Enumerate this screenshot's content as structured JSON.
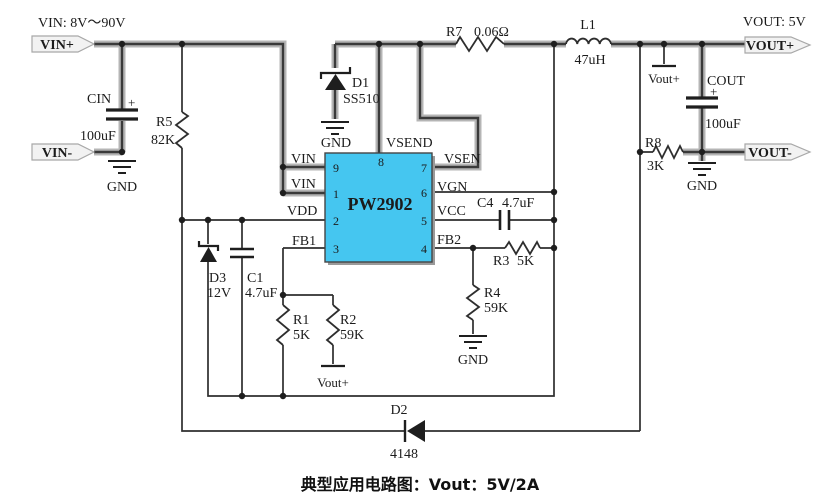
{
  "title": {
    "vin_spec": "VIN:  8V～90V",
    "vout_spec": "VOUT:  5V"
  },
  "caption": "典型应用电路图：Vout：5V/2A",
  "terminals": {
    "vin_plus": "VIN+",
    "vin_minus": "VIN-",
    "vout_plus": "VOUT+",
    "vout_minus": "VOUT-"
  },
  "net_labels": {
    "vout_ref_top": "Vout+",
    "vout_ref_bottom": "Vout+",
    "gnd": "GND"
  },
  "ic": {
    "part": "PW2902",
    "pins": {
      "p9": {
        "num": "9",
        "label": "VIN"
      },
      "p1": {
        "num": "1",
        "label": "VIN"
      },
      "p2": {
        "num": "2",
        "label": "VDD"
      },
      "p3": {
        "num": "3",
        "label": "FB1"
      },
      "p8": {
        "num": "8",
        "label": "VSEND"
      },
      "p7": {
        "num": "7",
        "label": "VSEN"
      },
      "p6": {
        "num": "6",
        "label": "VGN"
      },
      "p5": {
        "num": "5",
        "label": "VCC"
      },
      "p4": {
        "num": "4",
        "label": "FB2"
      }
    }
  },
  "components": {
    "cin": {
      "ref": "CIN",
      "value": "100uF",
      "polarity": "+"
    },
    "cout": {
      "ref": "COUT",
      "value": "100uF",
      "polarity": "+"
    },
    "c1": {
      "ref": "C1",
      "value": "4.7uF"
    },
    "c4": {
      "ref": "C4",
      "value": "4.7uF"
    },
    "r1": {
      "ref": "R1",
      "value": "5K"
    },
    "r2": {
      "ref": "R2",
      "value": "59K"
    },
    "r3": {
      "ref": "R3",
      "value": "5K"
    },
    "r4": {
      "ref": "R4",
      "value": "59K"
    },
    "r5": {
      "ref": "R5",
      "value": "82K"
    },
    "r7": {
      "ref": "R7",
      "value": "0.06Ω"
    },
    "r8": {
      "ref": "R8",
      "value": "3K"
    },
    "l1": {
      "ref": "L1",
      "value": "47uH"
    },
    "d1": {
      "ref": "D1",
      "value": "SS510"
    },
    "d2": {
      "ref": "D2",
      "value": "4148"
    },
    "d3": {
      "ref": "D3",
      "value": "12V"
    }
  },
  "colors": {
    "ic_fill": "#45c6f0",
    "wire_core": "#3a3a3a",
    "wire_halo": "#b5b5b5",
    "tag_fill": "#f2f2f2"
  }
}
